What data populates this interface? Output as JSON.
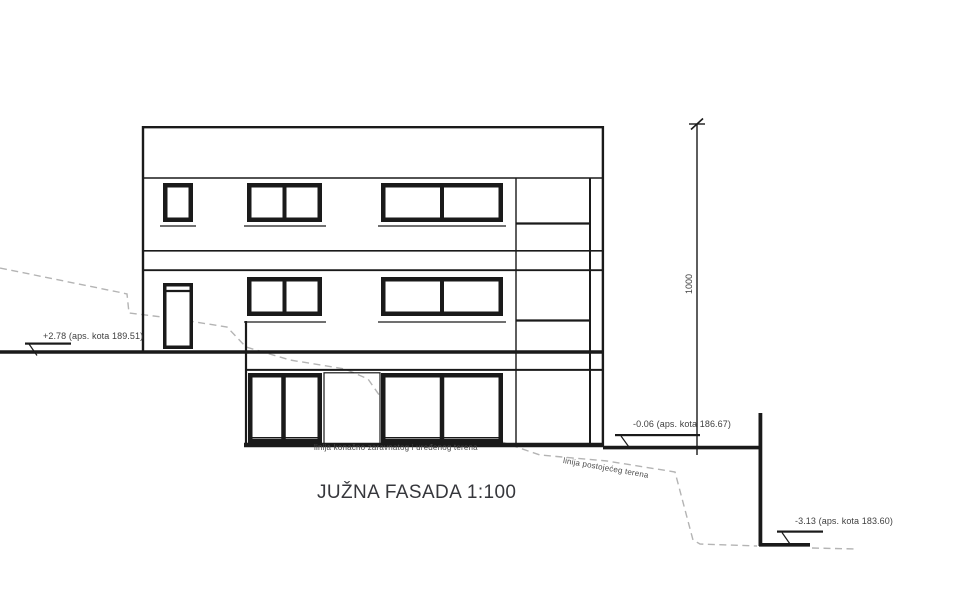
{
  "drawing": {
    "title": "JUŽNA FASADA 1:100",
    "elevation_markers": {
      "upper_left": "+2.78 (aps. kota 189.51)",
      "ground_right": "-0.06 (aps. kota 186.67)",
      "lower_right": "-3.13 (aps. kota 183.60)"
    },
    "dimension_height": "1000",
    "terrain_labels": {
      "finished": "linija konačno zaravnatog i uređenog terena",
      "existing": "linija postojećeg terena"
    },
    "colors": {
      "line": "#1a1a1a",
      "terrain_dash": "#b4b4b4",
      "text": "#3f3f3f"
    }
  }
}
